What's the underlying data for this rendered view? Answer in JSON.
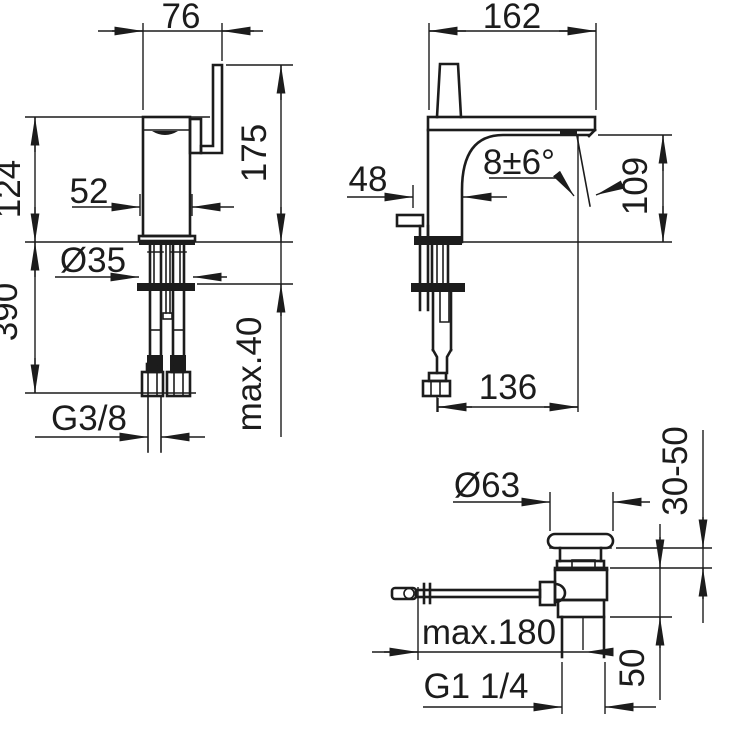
{
  "drawing_title": "Basin mixer technical dimension drawing",
  "line_color": "#1c1c1c",
  "background_color": "#ffffff",
  "views": {
    "side_view": {
      "name": "faucet side view",
      "dims": {
        "spout_block_width": "76",
        "height_above_deck": "124",
        "body_width": "52",
        "total_height": "175",
        "hole_diameter": "Ø35",
        "hose_length": "390",
        "max_deck_thickness": "max.40",
        "supply_thread": "G3/8"
      }
    },
    "front_view": {
      "name": "faucet front view",
      "dims": {
        "spout_projection": "162",
        "body_offset": "48",
        "stream_angle": "8±6°",
        "outlet_height": "109",
        "outlet_offset": "136"
      }
    },
    "drain_view": {
      "name": "pop-up waste side view",
      "dims": {
        "plug_diameter": "Ø63",
        "clamping_range": "30-50",
        "rod_length": "max.180",
        "body_height": "50",
        "waste_thread": "G1 1/4"
      }
    }
  }
}
